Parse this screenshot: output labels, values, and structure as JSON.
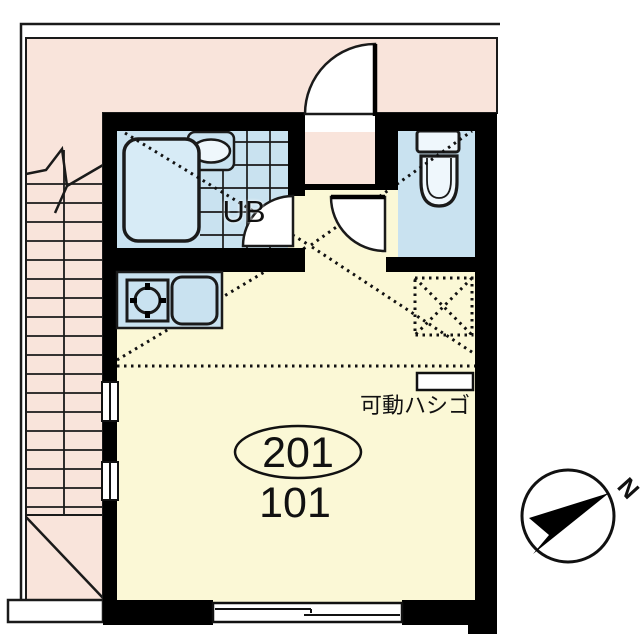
{
  "plan": {
    "unit_bath_label": "UB",
    "ladder_label": "可動ハシゴ",
    "room_number_circled": "201",
    "room_number_below": "101",
    "compass_north_label": "N"
  },
  "colors": {
    "exterior_pink": "#F9E4DB",
    "room_yellow": "#FBF8D6",
    "wet_area_blue": "#C9E2F0",
    "bathtub_blue": "#D7EBF6",
    "fixture_white": "#EFF7FC",
    "wall_black": "#000000",
    "background": "#FFFFFF"
  }
}
